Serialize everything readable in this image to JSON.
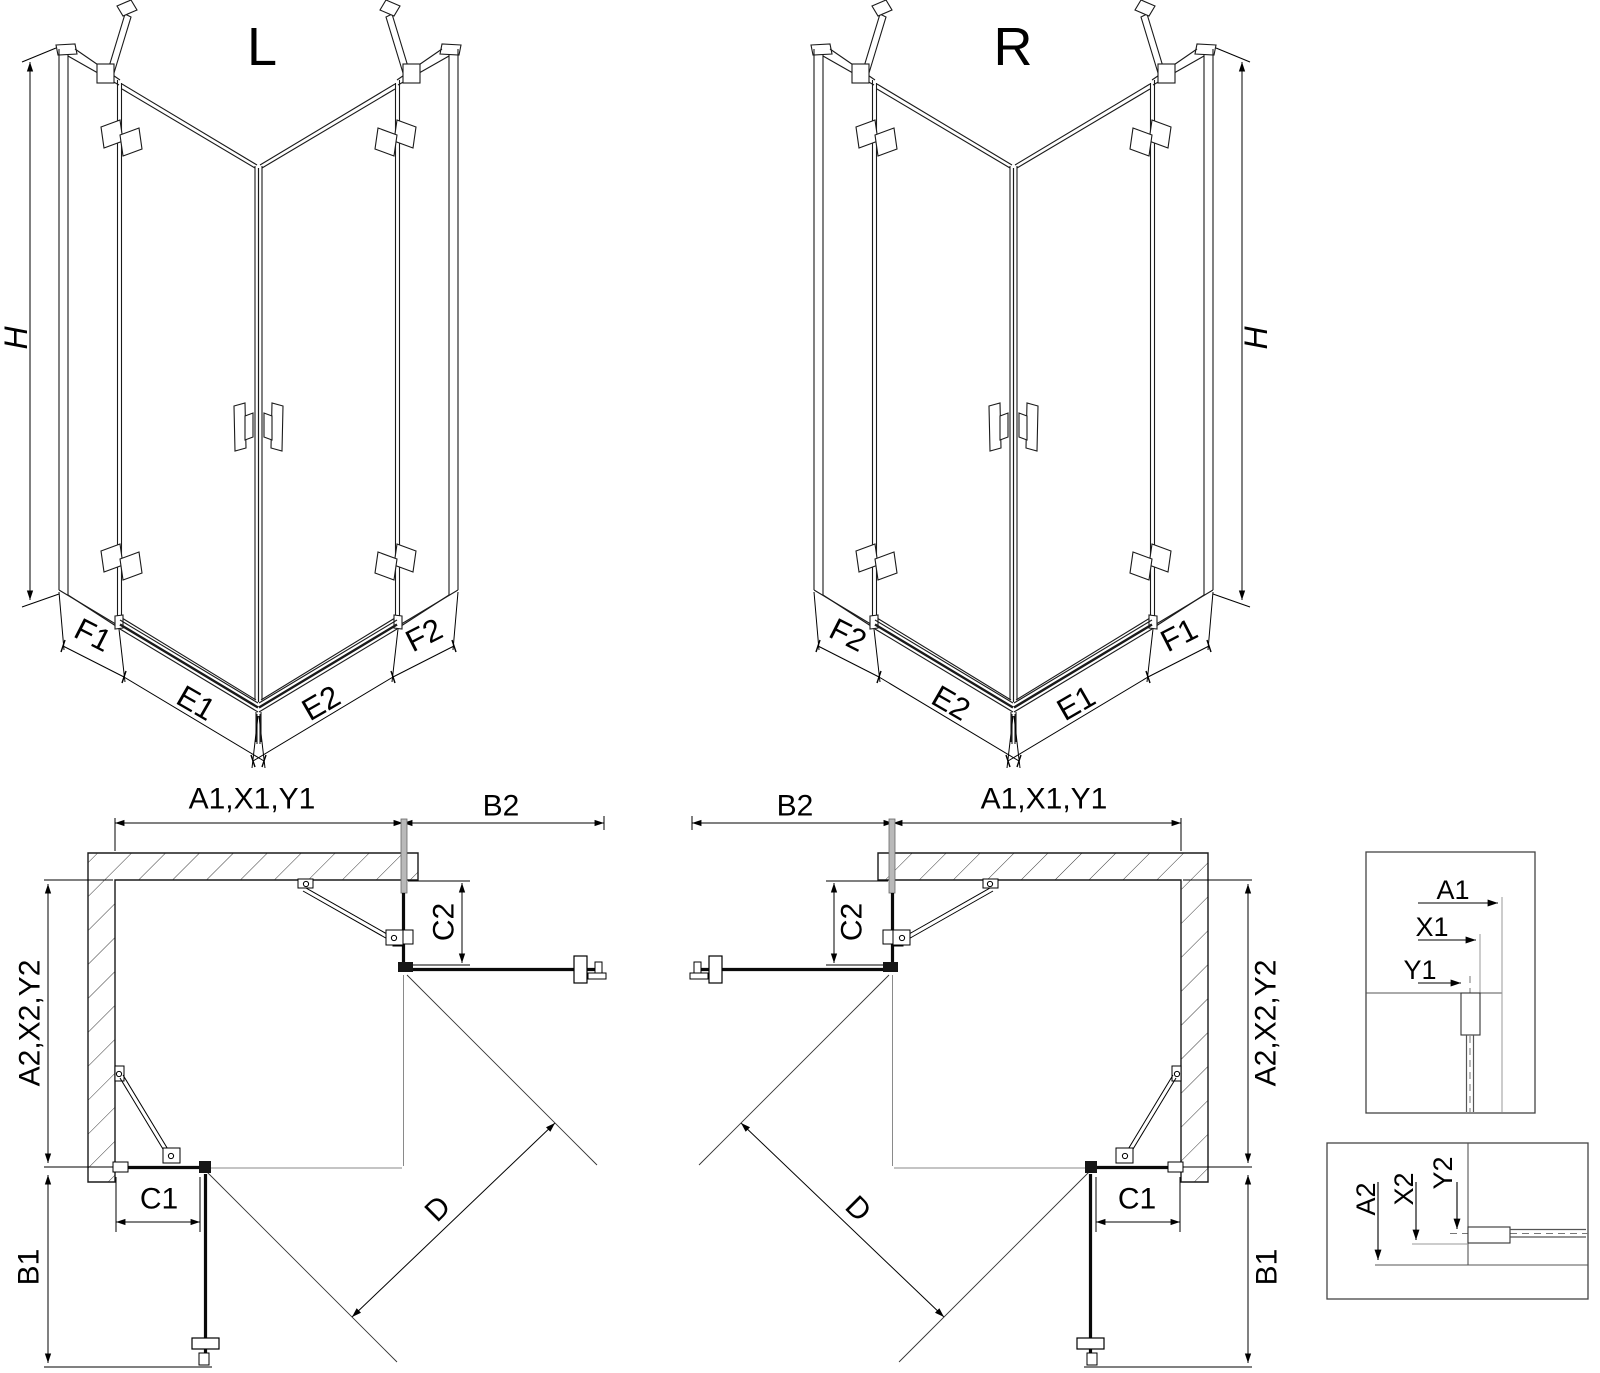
{
  "colors": {
    "line": "#1a1a1a",
    "dim": "#000000",
    "grey": "#8a8a8a",
    "profile_fill": "#b9b9b9",
    "background": "#ffffff"
  },
  "views": {
    "perspective_left": {
      "title": "L",
      "h": "H",
      "f1": "F1",
      "e1": "E1",
      "e2": "E2",
      "f2": "F2"
    },
    "perspective_right": {
      "title": "R",
      "h": "H",
      "f1": "F1",
      "e1": "E1",
      "e2": "E2",
      "f2": "F2"
    },
    "plan_left": {
      "width_dim": "A1,X1,Y1",
      "b2": "B2",
      "c2": "C2",
      "depth_dim": "A2,X2,Y2",
      "c1": "C1",
      "b1": "B1",
      "d": "D"
    },
    "plan_right": {
      "width_dim": "A1,X1,Y1",
      "b2": "B2",
      "c2": "C2",
      "depth_dim": "A2,X2,Y2",
      "c1": "C1",
      "b1": "B1",
      "d": "D"
    },
    "detail_wall": {
      "a1": "A1",
      "x1": "X1",
      "y1": "Y1"
    },
    "detail_floor": {
      "a2": "A2",
      "x2": "X2",
      "y2": "Y2"
    }
  }
}
